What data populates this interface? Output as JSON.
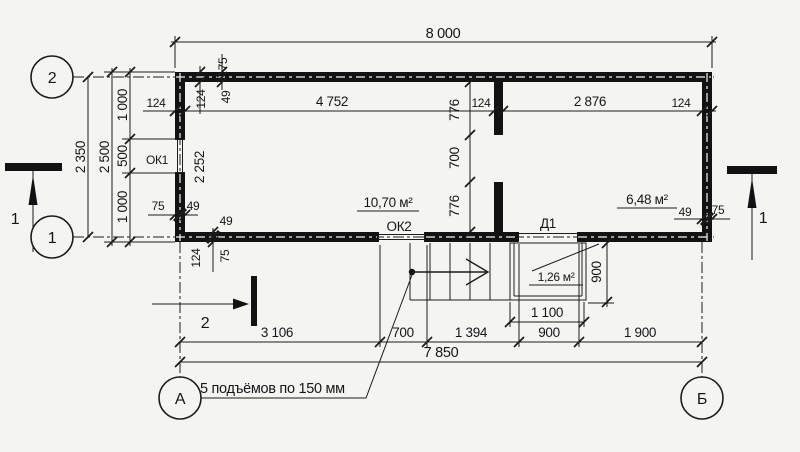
{
  "colors": {
    "background": "#f4f4f3",
    "ink": "#1b1b1b"
  },
  "plan": {
    "axis_circles": {
      "left_top": "2",
      "left_bottom": "1",
      "bottom_left": "А",
      "bottom_right": "Б"
    },
    "section_marks": {
      "left": "1",
      "right": "1",
      "bottom": "2"
    },
    "dims": {
      "overall_top": "8 000",
      "overall_bottom": "7 850",
      "left_outer": "2 350",
      "left_mid": "2 500",
      "left_inner": [
        "1 000",
        "500",
        "1 000"
      ],
      "top_row": [
        "124",
        "4 752",
        "124",
        "2 876",
        "124"
      ],
      "partition_col": [
        "776",
        "700",
        "776"
      ],
      "interior_left": "2 252",
      "wall_top": {
        "t75": "75",
        "t124": "124",
        "t49": "49"
      },
      "wall_left_bottom": {
        "t75": "75",
        "t49": "49"
      },
      "wall_bottom_left": {
        "t124": "124",
        "t75": "75",
        "t49": "49"
      },
      "wall_right_bottom": {
        "t49": "49",
        "t75": "75"
      },
      "bottom_row": [
        "3 106",
        "700",
        "1 394",
        "900",
        "1 900"
      ],
      "porch_width": "1 100",
      "porch_depth": "900"
    },
    "labels": {
      "window1": "ОК1",
      "window2": "ОК2",
      "door1": "Д1",
      "area_room1": "10,70 м²",
      "area_room2": "6,48 м²",
      "area_porch": "1,26 м²",
      "stair_note": "5 подъёмов по 150 мм"
    }
  }
}
